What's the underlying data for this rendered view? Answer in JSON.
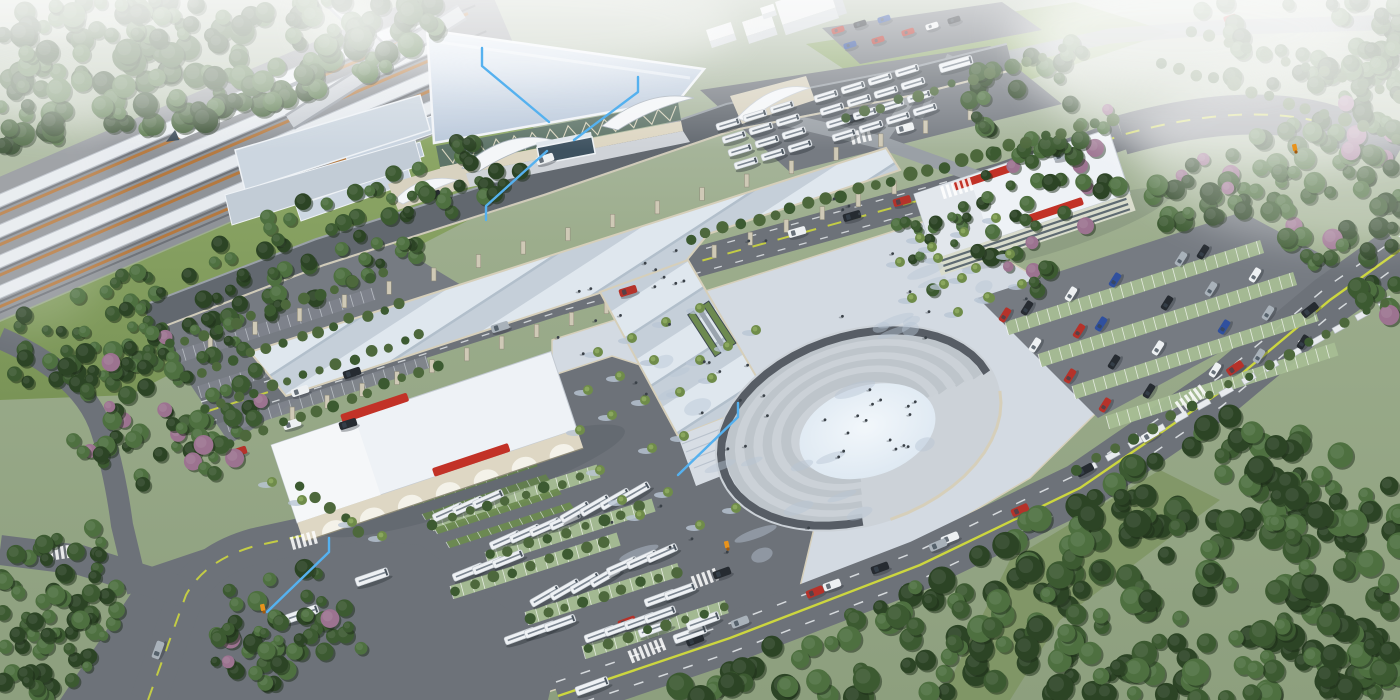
{
  "scene": {
    "title": "Aerial architectural rendering of a high-speed railway station complex with plaza, bus terminal, parking garage, roads and forest",
    "type": "3d-architectural-rendering"
  },
  "palette": {
    "land1": "#b4bfae",
    "land2": "#8d9f7e",
    "lawn1": "#8fa968",
    "lawn2": "#7a9457",
    "lawn3": "#93ab74",
    "asphalt": "#6d7279",
    "asphalt2": "#767b82",
    "asphaltlt": "#9aa0a6",
    "roadedge": "#d6cfba",
    "yellow": "#ccd63f",
    "white": "#e9ecef",
    "railbase": "#8f9398",
    "canopy": "#e6eaee",
    "canopyedge": "#b9bfc7",
    "railorange": "#b5793f",
    "railtrack": "#6e7278",
    "roofhi": "#e3ebf4",
    "rooflo": "#b6c5d8",
    "fascia": "#f0f3f7",
    "glass": "#5e7468",
    "mullion": "#e6dfc8",
    "plinth": "#ddd6c2",
    "cream": "#d8d2c0",
    "deck1": "#c5cfd9",
    "deck2": "#dfe7ee",
    "deck3": "#b2bfcb",
    "plaza": "#d3dae2",
    "plazash": "#b9c5d5",
    "pavelt": "#dde2e8",
    "step1": "#cbd1d7",
    "step2": "#bec5cb",
    "ringpath": "#575d65",
    "oval1": "#f2f7fb",
    "oval2": "#d9e5f0",
    "bldg": "#eef2f6",
    "bldgface": "#ded7c4",
    "bldgshade": "#c6ccd3",
    "red": "#c23227",
    "winband": "#5f6b72",
    "bay": "#a6bd94",
    "stall": "#7e838b",
    "hedge": "#4d683c",
    "shelter": "#6d8a50",
    "bus": "#eef1f4",
    "buswin": "#7b8590",
    "treed": "#2c4425",
    "treem": "#3c5a31",
    "treel": "#4e7040",
    "olive": "#6f8c4a",
    "pink": "#9c7390",
    "anno": "#55b1ef",
    "marker": "#e8931c",
    "shadow": "#2a3138",
    "carr": "#b5322a",
    "cark": "#262b31",
    "carw": "#edf0f2",
    "carb": "#30509e",
    "cars": "#a9b2ba"
  },
  "annotations": {
    "leader_lines": [
      {
        "points": [
          [
            482,
            48
          ],
          [
            482,
            66
          ],
          [
            549,
            122
          ]
        ]
      },
      {
        "points": [
          [
            638,
            77
          ],
          [
            638,
            92
          ],
          [
            574,
            140
          ]
        ]
      },
      {
        "points": [
          [
            547,
            151
          ],
          [
            486,
            206
          ],
          [
            486,
            220
          ]
        ]
      },
      {
        "points": [
          [
            738,
            403
          ],
          [
            738,
            417
          ],
          [
            678,
            475
          ]
        ]
      },
      {
        "points": [
          [
            329,
            538
          ],
          [
            329,
            552
          ],
          [
            267,
            612
          ]
        ]
      }
    ],
    "markers": [
      {
        "x": 263,
        "y": 610
      },
      {
        "x": 727,
        "y": 547
      },
      {
        "x": 1295,
        "y": 150
      }
    ]
  },
  "amphitheater": {
    "cx": 858,
    "cy": 428,
    "rot": -18,
    "rings": {
      "n": 7,
      "rx0": 74,
      "ry0": 48,
      "drx": 9.5,
      "dry": 6.2,
      "w": 9,
      "a0": 100,
      "a1": 358
    },
    "path": {
      "rx": 141,
      "ry": 92,
      "w": 8,
      "a0": 100,
      "a1": 358
    },
    "inner": {
      "rx": 70,
      "ry": 45,
      "dx": 8,
      "dy": 6
    },
    "wall": {
      "rx": 147,
      "ry": 97,
      "a0": 5,
      "a1": 95
    }
  },
  "vegetation": {
    "regions": [
      {
        "poly": [
          [
            0,
            0
          ],
          [
            460,
            0
          ],
          [
            425,
            58
          ],
          [
            230,
            118
          ],
          [
            60,
            152
          ],
          [
            0,
            150
          ]
        ],
        "n": 190,
        "rmin": 6,
        "rmax": 13,
        "pink": 0,
        "seed": 1
      },
      {
        "poly": [
          [
            0,
            322
          ],
          [
            455,
            140
          ],
          [
            548,
            148
          ],
          [
            430,
            252
          ],
          [
            120,
            380
          ],
          [
            0,
            390
          ]
        ],
        "n": 130,
        "rmin": 5,
        "rmax": 9,
        "pink": 0,
        "seed": 2
      },
      {
        "poly": [
          [
            62,
            352
          ],
          [
            238,
            312
          ],
          [
            295,
            425
          ],
          [
            170,
            508
          ],
          [
            62,
            462
          ]
        ],
        "n": 85,
        "rmin": 5,
        "rmax": 10,
        "pink": 0.12,
        "seed": 3
      },
      {
        "poly": [
          [
            968,
            72
          ],
          [
            1078,
            40
          ],
          [
            1138,
            162
          ],
          [
            1052,
            300
          ],
          [
            976,
            256
          ]
        ],
        "n": 70,
        "rmin": 5,
        "rmax": 10,
        "pink": 0.15,
        "seed": 4
      },
      {
        "poly": [
          [
            1145,
            188
          ],
          [
            1400,
            62
          ],
          [
            1400,
            330
          ],
          [
            1352,
            300
          ],
          [
            1258,
            214
          ],
          [
            1162,
            232
          ]
        ],
        "n": 110,
        "rmin": 6,
        "rmax": 11,
        "pink": 0.12,
        "seed": 5
      },
      {
        "poly": [
          [
            640,
            700
          ],
          [
            878,
            598
          ],
          [
            1238,
            410
          ],
          [
            1400,
            472
          ],
          [
            1400,
            700
          ]
        ],
        "n": 300,
        "rmin": 7,
        "rmax": 14,
        "pink": 0,
        "seed": 6
      },
      {
        "poly": [
          [
            0,
            545
          ],
          [
            95,
            522
          ],
          [
            135,
            615
          ],
          [
            70,
            700
          ],
          [
            0,
            700
          ]
        ],
        "n": 70,
        "rmin": 5,
        "rmax": 10,
        "pink": 0,
        "seed": 7
      },
      {
        "poly": [
          [
            215,
            592
          ],
          [
            332,
            560
          ],
          [
            365,
            655
          ],
          [
            262,
            700
          ],
          [
            215,
            665
          ]
        ],
        "n": 55,
        "rmin": 5,
        "rmax": 10,
        "pink": 0.1,
        "seed": 8
      },
      {
        "poly": [
          [
            1150,
            0
          ],
          [
            1400,
            0
          ],
          [
            1400,
            95
          ],
          [
            1235,
            85
          ]
        ],
        "n": 50,
        "rmin": 6,
        "rmax": 11,
        "pink": 0,
        "seed": 9
      },
      {
        "poly": [
          [
            895,
            222
          ],
          [
            962,
            196
          ],
          [
            986,
            270
          ],
          [
            920,
            302
          ]
        ],
        "n": 16,
        "rmin": 4,
        "rmax": 7,
        "pink": 0,
        "seed": 10
      }
    ],
    "hedges": [
      [
        690,
        238,
        1112,
        118,
        26,
        6
      ],
      [
        1075,
        470,
        1385,
        302,
        17,
        5
      ],
      [
        170,
        345,
        385,
        272,
        14,
        5
      ],
      [
        185,
        377,
        400,
        303,
        14,
        5
      ],
      [
        205,
        410,
        420,
        335,
        14,
        5
      ],
      [
        230,
        443,
        437,
        366,
        13,
        5
      ],
      [
        845,
        118,
        1062,
        50,
        13,
        5
      ],
      [
        1160,
        62,
        1398,
        138,
        14,
        6
      ],
      [
        1190,
        30,
        1400,
        96,
        12,
        6
      ],
      [
        432,
        524,
        580,
        477,
        9,
        5
      ],
      [
        490,
        556,
        640,
        508,
        9,
        5
      ],
      [
        455,
        590,
        605,
        542,
        9,
        5
      ],
      [
        530,
        618,
        675,
        572,
        9,
        5
      ],
      [
        588,
        650,
        726,
        606,
        8,
        5
      ],
      [
        300,
        486,
        360,
        530,
        5,
        5
      ]
    ],
    "plaza_trees": [
      [
        598,
        352
      ],
      [
        632,
        338
      ],
      [
        666,
        322
      ],
      [
        700,
        308
      ],
      [
        588,
        390
      ],
      [
        620,
        376
      ],
      [
        654,
        360
      ],
      [
        580,
        430
      ],
      [
        612,
        415
      ],
      [
        645,
        400
      ],
      [
        700,
        360
      ],
      [
        728,
        346
      ],
      [
        680,
        392
      ],
      [
        712,
        378
      ],
      [
        652,
        448
      ],
      [
        684,
        436
      ],
      [
        640,
        515
      ],
      [
        668,
        492
      ],
      [
        700,
        525
      ],
      [
        600,
        470
      ],
      [
        622,
        500
      ],
      [
        736,
        508
      ],
      [
        756,
        330
      ],
      [
        900,
        262
      ],
      [
        932,
        247
      ],
      [
        964,
        232
      ],
      [
        996,
        218
      ],
      [
        912,
        298
      ],
      [
        944,
        284
      ],
      [
        976,
        268
      ],
      [
        1010,
        254
      ],
      [
        958,
        312
      ],
      [
        990,
        298
      ],
      [
        1022,
        284
      ],
      [
        938,
        258
      ],
      [
        962,
        278
      ],
      [
        988,
        297
      ],
      [
        920,
        238
      ],
      [
        352,
        522
      ],
      [
        382,
        536
      ],
      [
        302,
        500
      ],
      [
        272,
        482
      ]
    ]
  },
  "people_regions": [
    {
      "poly": [
        [
          500,
          310
        ],
        [
          860,
          182
        ],
        [
          892,
          212
        ],
        [
          580,
          352
        ]
      ],
      "n": 18,
      "seed": 17
    },
    {
      "poly": [
        [
          580,
          350
        ],
        [
          940,
          228
        ],
        [
          1040,
          300
        ],
        [
          980,
          420
        ],
        [
          800,
          560
        ],
        [
          650,
          600
        ],
        [
          580,
          480
        ]
      ],
      "n": 24,
      "seed": 11
    },
    {
      "poly": [
        [
          800,
          390
        ],
        [
          915,
          385
        ],
        [
          925,
          455
        ],
        [
          810,
          465
        ]
      ],
      "n": 12,
      "seed": 13
    },
    {
      "poly": [
        [
          690,
          380
        ],
        [
          760,
          355
        ],
        [
          790,
          440
        ],
        [
          700,
          470
        ]
      ],
      "n": 6,
      "seed": 15
    }
  ],
  "shadow_blotches": {
    "poly": [
      [
        580,
        350
      ],
      [
        940,
        228
      ],
      [
        1040,
        300
      ],
      [
        980,
        420
      ],
      [
        800,
        560
      ],
      [
        650,
        600
      ],
      [
        580,
        480
      ]
    ],
    "n": 24,
    "seed": 21
  },
  "vehicles": {
    "road_cars": [
      [
        300,
        391,
        -18,
        "w"
      ],
      [
        352,
        373,
        -18,
        "k"
      ],
      [
        500,
        327,
        -17,
        "s"
      ],
      [
        628,
        291,
        -17,
        "r"
      ],
      [
        797,
        232,
        -16,
        "w"
      ],
      [
        852,
        216,
        -16,
        "k"
      ],
      [
        902,
        201,
        -16,
        "r"
      ],
      [
        1062,
        155,
        -17,
        "s"
      ],
      [
        432,
        196,
        -19,
        "k"
      ],
      [
        545,
        159,
        -18,
        "w"
      ],
      [
        695,
        640,
        -21,
        "k"
      ],
      [
        740,
        622,
        -21,
        "s"
      ],
      [
        815,
        592,
        -22,
        "r"
      ],
      [
        880,
        568,
        -20,
        "k"
      ],
      [
        950,
        538,
        -22,
        "w"
      ],
      [
        1020,
        510,
        -24,
        "r"
      ],
      [
        1085,
        470,
        -28,
        "k"
      ],
      [
        1150,
        435,
        -31,
        "w"
      ],
      [
        1235,
        368,
        -35,
        "r"
      ],
      [
        1310,
        310,
        -38,
        "k"
      ],
      [
        832,
        585,
        -20,
        "w"
      ],
      [
        938,
        545,
        -23,
        "s"
      ],
      [
        722,
        573,
        -20,
        "k"
      ],
      [
        627,
        622,
        -20,
        "r"
      ],
      [
        238,
        452,
        -18,
        "r"
      ],
      [
        292,
        424,
        -17,
        "w"
      ],
      [
        348,
        424,
        -17,
        "k"
      ],
      [
        158,
        650,
        -70,
        "s"
      ],
      [
        905,
        128,
        -15,
        "w"
      ],
      [
        855,
        118,
        -14,
        "k"
      ]
    ],
    "lot_cars_rot": -58,
    "lot_cars": [
      [
        1005,
        315,
        "r"
      ],
      [
        1027,
        308,
        "k"
      ],
      [
        1071,
        294,
        "w"
      ],
      [
        1115,
        280,
        "b"
      ],
      [
        1181,
        259,
        "s"
      ],
      [
        1203,
        252,
        "k"
      ],
      [
        1035,
        345,
        "w"
      ],
      [
        1079,
        331,
        "r"
      ],
      [
        1101,
        324,
        "b"
      ],
      [
        1167,
        303,
        "k"
      ],
      [
        1211,
        289,
        "s"
      ],
      [
        1255,
        275,
        "w"
      ],
      [
        1070,
        376,
        "r"
      ],
      [
        1114,
        362,
        "k"
      ],
      [
        1158,
        348,
        "w"
      ],
      [
        1224,
        327,
        "b"
      ],
      [
        1268,
        313,
        "s"
      ],
      [
        1105,
        405,
        "r"
      ],
      [
        1149,
        391,
        "k"
      ],
      [
        1215,
        370,
        "w"
      ],
      [
        1259,
        356,
        "s"
      ],
      [
        1303,
        342,
        "k"
      ]
    ],
    "top_cars": [
      [
        838,
        30,
        "r"
      ],
      [
        860,
        24,
        "k"
      ],
      [
        884,
        19,
        "b"
      ],
      [
        908,
        32,
        "r"
      ],
      [
        932,
        26,
        "w"
      ],
      [
        954,
        20,
        "k"
      ],
      [
        850,
        45,
        "b"
      ],
      [
        878,
        40,
        "r"
      ],
      [
        1230,
        18,
        "r"
      ]
    ],
    "buses": [
      [
        592,
        686,
        -20
      ],
      [
        690,
        634,
        -20
      ],
      [
        655,
        628,
        -20
      ],
      [
        703,
        621,
        -20
      ],
      [
        372,
        577,
        -19
      ],
      [
        302,
        614,
        -19
      ],
      [
        956,
        64,
        -16
      ]
    ],
    "bus_clusters": [
      [
        448,
        512,
        3,
        -24
      ],
      [
        505,
        540,
        4,
        -24
      ],
      [
        575,
        512,
        4,
        -30
      ],
      [
        468,
        572,
        3,
        -22
      ],
      [
        545,
        596,
        4,
        -30
      ],
      [
        622,
        566,
        3,
        -24
      ],
      [
        600,
        634,
        4,
        -20
      ],
      [
        520,
        636,
        3,
        -20
      ],
      [
        660,
        598,
        2,
        -20
      ]
    ],
    "bus_grids": [
      {
        "x": 728,
        "y": 124,
        "rows": 4,
        "cols": 3
      },
      {
        "x": 826,
        "y": 96,
        "rows": 4,
        "cols": 4
      }
    ]
  },
  "lots": {
    "green_rows": [
      [
        1005,
        322,
        268
      ],
      [
        1038,
        354,
        268
      ],
      [
        1072,
        386,
        255
      ],
      [
        1106,
        416,
        240
      ],
      [
        430,
        518,
        175
      ],
      [
        485,
        552,
        175
      ],
      [
        450,
        586,
        175
      ],
      [
        525,
        612,
        160
      ],
      [
        582,
        646,
        150
      ]
    ],
    "canopy_rows": [
      [
        398,
        486,
        130
      ],
      [
        410,
        500,
        130
      ],
      [
        422,
        514,
        130
      ],
      [
        434,
        528,
        130
      ],
      [
        446,
        542,
        130
      ]
    ],
    "stall_rows": [
      [
        172,
        352,
        210
      ],
      [
        198,
        386,
        210
      ],
      [
        226,
        420,
        210
      ]
    ]
  },
  "piers": [
    {
      "x1": 292,
      "y1": 404,
      "x2": 676,
      "y2": 274,
      "step": 36,
      "drop": 3
    },
    {
      "x1": 714,
      "y1": 242,
      "x2": 894,
      "y2": 178,
      "step": 36,
      "drop": 3
    },
    {
      "x1": 210,
      "y1": 324,
      "x2": 970,
      "y2": 96,
      "step": 46,
      "drop": 11
    }
  ],
  "crosswalks": [
    [
      958,
      188,
      -17,
      6
    ],
    [
      862,
      136,
      -13,
      4
    ],
    [
      648,
      650,
      -22,
      7
    ],
    [
      1192,
      398,
      -36,
      6
    ],
    [
      58,
      553,
      -8,
      5
    ],
    [
      706,
      578,
      -20,
      5
    ],
    [
      305,
      540,
      -15,
      5
    ]
  ],
  "shelter_row": {
    "x1": 1090,
    "y1": 468,
    "x2": 1385,
    "y2": 302,
    "n": 14
  }
}
